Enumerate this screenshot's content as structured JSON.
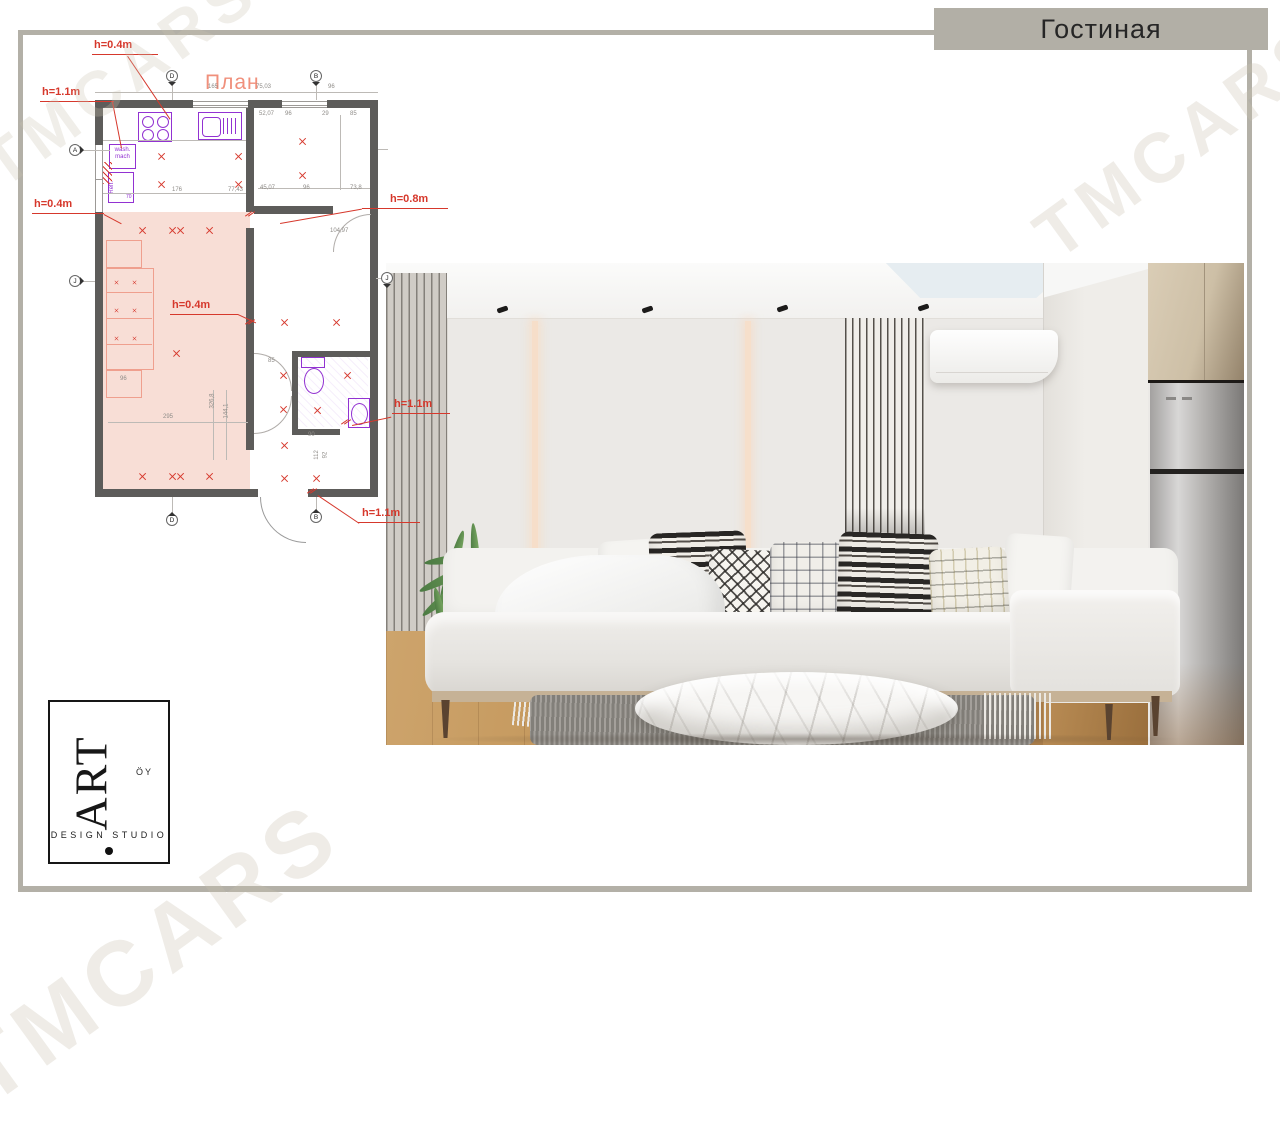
{
  "page": {
    "banner_title": "Гостиная",
    "watermark": "TMCARS",
    "accent_colors": {
      "frame_taupe": "#b3b0a7",
      "annotation_red": "#d6382c",
      "fixture_purple": "#9232d2",
      "plan_fill_pink": "#f8ded6"
    }
  },
  "plan": {
    "title": "План",
    "annotations": [
      "h=0.4m",
      "h=1.1m",
      "h=0.4m",
      "h=0.8m",
      "h=0.4m",
      "h=1.1m",
      "h=1.1m"
    ],
    "appliances": {
      "wash_mach": "wash. mach",
      "refr": "Refr.",
      "refr_width": "70"
    },
    "grid_markers": [
      "D",
      "B",
      "A",
      "J",
      "D",
      "B",
      "J"
    ],
    "dims": {
      "top": [
        "165",
        "75,03",
        "96"
      ],
      "room_mid": [
        "52,07",
        "96",
        "29",
        "85"
      ],
      "room_bottom": [
        "45,07",
        "96",
        "73,8"
      ],
      "kitchen": [
        "176",
        "77,43"
      ],
      "living": [
        "96",
        "295",
        "326,8",
        "144,1"
      ],
      "hall": [
        "85",
        "90",
        "104,97",
        "112",
        "92"
      ]
    }
  },
  "render": {
    "scene": "living-room-photorender",
    "objects": [
      "ceiling-spotlights",
      "skylight",
      "wood-slat-panel-left",
      "wood-slat-panel-center",
      "backlit-wall-panels",
      "air-conditioner",
      "kitchen-cabinets",
      "refrigerator",
      "sofa",
      "patterned-pillows",
      "throw-blanket",
      "potted-plant",
      "marble-coffee-table",
      "rug",
      "wood-floor"
    ]
  },
  "logo": {
    "brand": "ART",
    "suffix": "ÖY",
    "subtitle": "DESIGN STUDIO"
  }
}
